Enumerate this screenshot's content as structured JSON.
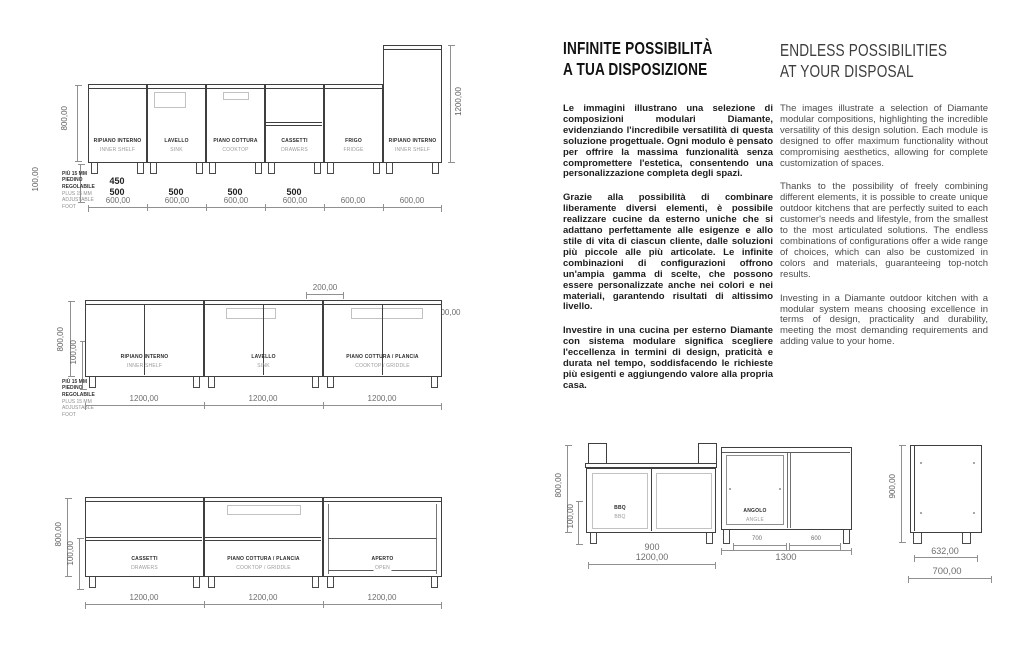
{
  "colors": {
    "ink": "#3f3f3f",
    "dim": "#909090",
    "text_it": "#1d1d1d",
    "text_en": "#4c4c4c"
  },
  "italian": {
    "title_line1": "INFINITE POSSIBILITÀ",
    "title_line2": "A TUA DISPOSIZIONE",
    "p1": "Le immagini illustrano una selezione di composizioni modulari Diamante, evidenziando l'incredibile versatilità di questa soluzione progettuale. Ogni modulo è pensato per offrire la massima funzionalità senza compromettere l'estetica, consentendo una personalizzazione completa degli spazi.",
    "p2": "Grazie alla possibilità di combinare liberamente diversi elementi, è possibile realizzare cucine da esterno uniche che si adattano perfettamente alle esigenze e allo stile di vita di ciascun cliente, dalle soluzioni più piccole alle più articolate. Le infinite combinazioni di configurazioni offrono un'ampia gamma di scelte, che possono essere personalizzate anche nei colori e nei materiali, garantendo risultati di altissimo livello.",
    "p3": "Investire in una cucina per esterno Diamante con sistema modulare significa scegliere l'eccellenza in termini di design, praticità e durata nel tempo, soddisfacendo le richieste più esigenti e aggiungendo valore alla propria casa."
  },
  "english": {
    "title_line1": "ENDLESS POSSIBILITIES",
    "title_line2": "AT YOUR DISPOSAL",
    "p1": "The images illustrate a selection of Diamante modular compositions, highlighting the incredible versatility of this design solution. Each module is designed to offer maximum functionality without compromising aesthetics, allowing for complete customization of spaces.",
    "p2": "Thanks to the possibility of freely combining different elements, it is possible to create unique outdoor kitchens that are perfectly suited to each customer's needs and lifestyle, from the smallest to the most articulated solutions. The endless combinations of configurations offer a wide range of choices, which can also be customized in colors and materials, guaranteeing top-notch results.",
    "p3": "Investing in a Diamante outdoor kitchen with a modular system means choosing excellence in terms of design, practicality and durability, meeting the most demanding requirements and adding value to your home."
  },
  "left_drawings": {
    "foot_note_bold": "PIÙ 15 MM\nPIEDINO\nREGOLABILE",
    "foot_note_light": "PLUS 15 MM\nADJUSTABLE\nFOOT",
    "d1": {
      "dim_height": "800,00",
      "dim_foot": "100,00",
      "dim_tall": "1200,00",
      "modules": [
        {
          "it": "RIPIANO INTERNO",
          "en": "INNER SHELF",
          "top_dim_1": "450",
          "top_dim_2": "500",
          "bottom_dim": "600,00"
        },
        {
          "it": "LAVELLO",
          "en": "SINK",
          "top_dim_2": "500",
          "bottom_dim": "600,00"
        },
        {
          "it": "PIANO COTTURA",
          "en": "COOKTOP",
          "top_dim_2": "500",
          "bottom_dim": "600,00"
        },
        {
          "it": "CASSETTI",
          "en": "DRAWERS",
          "top_dim_2": "500",
          "bottom_dim": "600,00"
        },
        {
          "it": "FRIGO",
          "en": "FRIDGE",
          "bottom_dim": "600,00"
        },
        {
          "it": "RIPIANO INTERNO",
          "en": "INNER SHELF",
          "bottom_dim": "600,00"
        }
      ]
    },
    "d2": {
      "dim_height": "800,00",
      "dim_foot": "100,00",
      "dim_top_a": "200,00",
      "dim_top_b": "10,00",
      "dim_top_c": "200,00",
      "modules": [
        {
          "it": "RIPIANO INTERNO",
          "en": "INNER SHELF",
          "bottom_dim": "1200,00"
        },
        {
          "it": "LAVELLO",
          "en": "SINK",
          "bottom_dim": "1200,00"
        },
        {
          "it": "PIANO COTTURA / PLANCIA",
          "en": "COOKTOP / GRIDDLE",
          "bottom_dim": "1200,00"
        }
      ]
    },
    "d3": {
      "dim_height": "800,00",
      "dim_foot": "100,00",
      "modules": [
        {
          "it": "CASSETTI",
          "en": "DRAWERS",
          "bottom_dim": "1200,00"
        },
        {
          "it": "PIANO COTTURA / PLANCIA",
          "en": "COOKTOP / GRIDDLE",
          "bottom_dim": "1200,00"
        },
        {
          "it": "APERTO",
          "en": "OPEN",
          "bottom_dim": "1200,00"
        }
      ]
    }
  },
  "bottom_drawings": {
    "d4": {
      "dim_height": "800,00",
      "dim_foot": "100,00",
      "bbq": {
        "it": "BBQ",
        "en": "BBQ",
        "dim_top": "900",
        "dim_bottom": "1200,00"
      },
      "angolo": {
        "it": "ANGOLO",
        "en": "ANGLE",
        "dim_left": "700",
        "dim_right": "600",
        "dim_total": "1300"
      }
    },
    "d5": {
      "dim_height": "900,00",
      "dim_inner": "632,00",
      "dim_outer": "700,00"
    }
  }
}
